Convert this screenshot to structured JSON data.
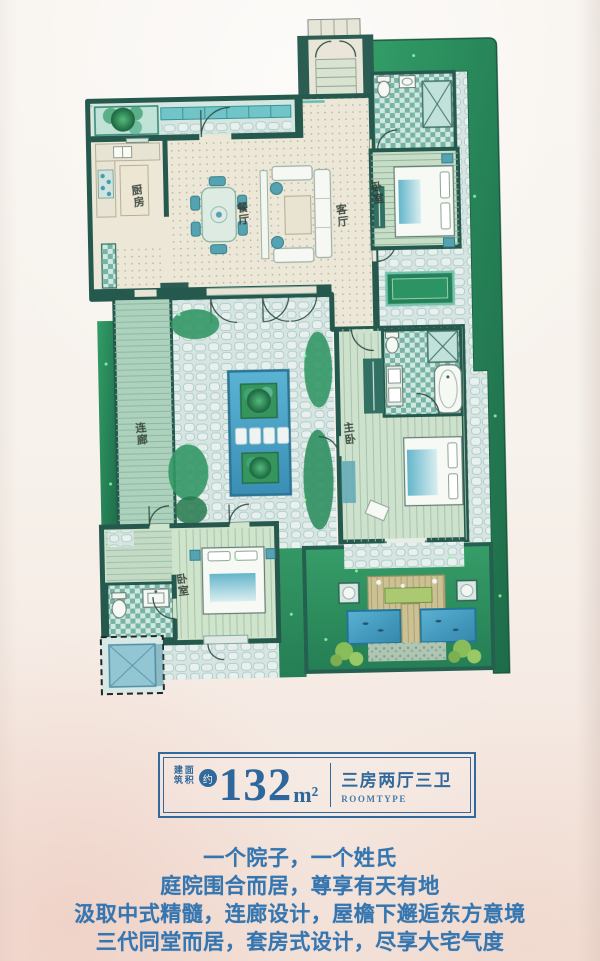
{
  "badge": {
    "area_label_cols": [
      "建筑",
      "面积"
    ],
    "approx_mark": "约",
    "area_value": "132",
    "area_unit": "m²",
    "room_type_cn": "三房两厅三卫",
    "room_type_en": "ROOMTYPE"
  },
  "slogans": [
    "一个院子，一个姓氏",
    "庭院围合而居，尊享有天有地",
    "汲取中式精髓，连廊设计，屋檐下邂逅东方意境",
    "三代同堂而居，套房式设计，尽享大宅气度"
  ],
  "floorplan": {
    "labels": {
      "kitchen": "厨房",
      "dining": "餐厅",
      "living": "客厅",
      "bedroom_north": "卧室",
      "corridor": "连廊",
      "master_bedroom": "主卧",
      "bedroom_south": "卧室"
    }
  },
  "colors": {
    "badge_blue": "#31699c",
    "slogan_blue": "#3576b0",
    "wall_teal": "#1e5348",
    "water_blue": "#3e9cc4",
    "garden_green": "#2f9a63"
  }
}
